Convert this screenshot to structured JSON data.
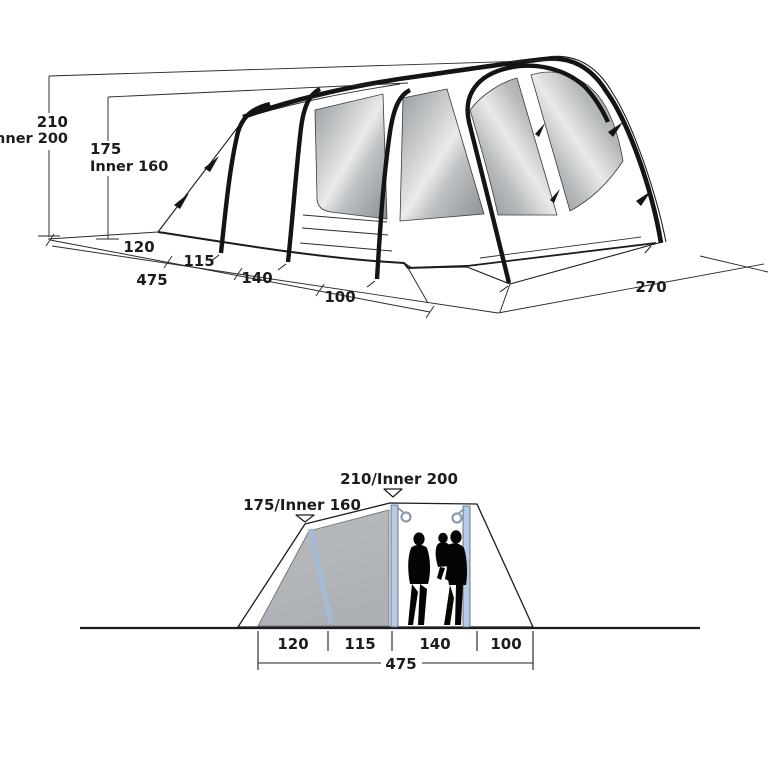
{
  "top_view": {
    "height_total": "210",
    "height_total_inner": "Inner 200",
    "height_side": "175",
    "height_side_inner": "Inner 160",
    "base_segments": [
      "120",
      "115",
      "140",
      "100"
    ],
    "base_total": "475",
    "width_front": "270"
  },
  "bottom_view": {
    "peak_label": "210/Inner 200",
    "side_label": "175/Inner 160",
    "floor_segments": [
      "120",
      "115",
      "140",
      "100"
    ],
    "floor_total": "475"
  },
  "colors": {
    "line": "#1c1c1e",
    "tube_black": "#141414",
    "window_gray_dark": "#8b8f92",
    "window_gray_light": "#eaebeb",
    "inner_panel_gray": "#b3b7bb",
    "pole_blue": "#aec4e0",
    "silhouette_black": "#050505",
    "background": "#ffffff"
  }
}
